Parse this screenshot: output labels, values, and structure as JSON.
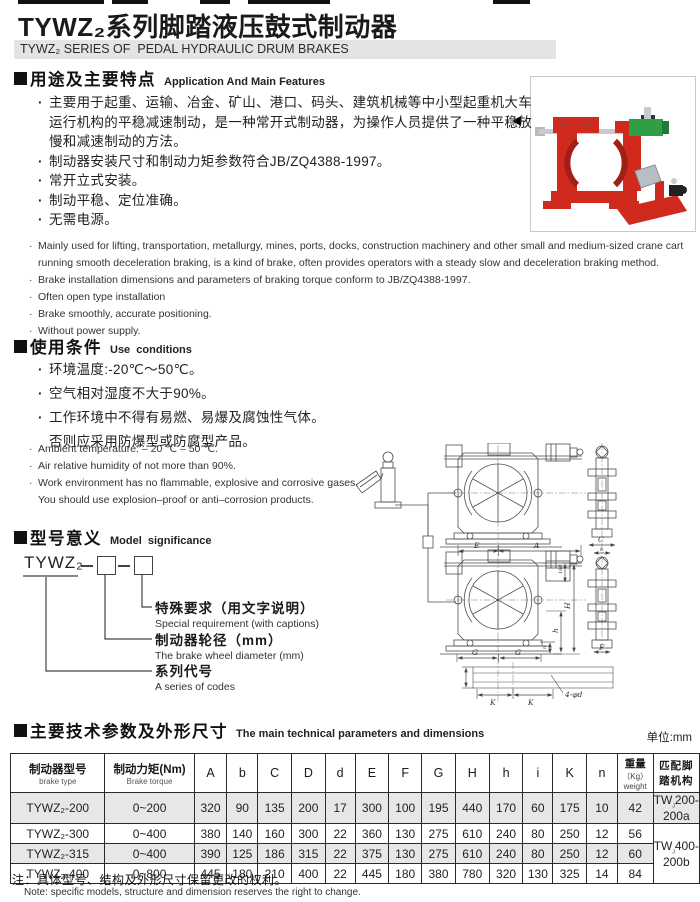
{
  "page": {
    "title": "TYWZ₂系列脚踏液压鼓式制动器",
    "subtitle": "TYWZ₂ SERIES OF  PEDAL HYDRAULIC DRUM BRAKES"
  },
  "sections": {
    "features": {
      "heading_cn": "用途及主要特点",
      "heading_en": "Application And Main Features",
      "bullets_cn": [
        "主要用于起重、运输、冶金、矿山、港口、码头、建筑机械等中小型起重机大车运行机构的平稳减速制动，是一种常开式制动器，为操作人员提供了一种平稳放慢和减速制动的方法。",
        "制动器安装尺寸和制动力矩参数符合JB/ZQ4388-1997。",
        "常开立式安装。",
        "制动平稳、定位准确。",
        "无需电源。"
      ],
      "bullets_en": [
        "Mainly used for lifting, transportation, metallurgy, mines, ports, docks, construction machinery and other small and medium-sized crane cart\nrunning smooth deceleration braking, is a kind of brake, often provides operators with a steady slow and deceleration braking method.",
        "Brake installation dimensions and parameters of braking torque conform to JB/ZQ4388-1997.",
        "Often open type installation",
        "Brake smoothly, accurate positioning.",
        "Without power supply."
      ]
    },
    "conditions": {
      "heading_cn": "使用条件",
      "heading_en": "Use  conditions",
      "bullets_cn": [
        "环境温度:-20℃～50℃。",
        "空气相对湿度不大于90%。",
        "工作环境中不得有易燃、易爆及腐蚀性气体。\n否则应采用防爆型或防腐型产品。"
      ],
      "bullets_en": [
        "Ambient temperature: – 20 ℃ – 50 ℃.",
        "Air relative humidity of not more than 90%.",
        "Work environment has no flammable, explosive and corrosive gases.\nYou should use explosion–proof or anti–corrosion products."
      ]
    },
    "model": {
      "heading_cn": "型号意义",
      "heading_en": "Model  significance",
      "code": "TYWZ₂",
      "labels": [
        {
          "cn": "特殊要求（用文字说明）",
          "en": "Special requirement (with captions)"
        },
        {
          "cn": "制动器轮径（mm）",
          "en": "The brake wheel diameter (mm)"
        },
        {
          "cn": "系列代号",
          "en": "A series of codes"
        }
      ]
    },
    "parameters": {
      "heading_cn": "主要技术参数及外形尺寸",
      "heading_en": "The main technical parameters and dimensions",
      "unit_note": "单位:mm",
      "table": {
        "col_model": {
          "cn": "制动器型号",
          "en": "brake type"
        },
        "col_torque": {
          "cn": "制动力矩(Nm)",
          "en": "Brake torque"
        },
        "dim_cols": [
          "A",
          "b",
          "C",
          "D",
          "d",
          "E",
          "F",
          "G",
          "H",
          "h",
          "i",
          "K",
          "n"
        ],
        "col_weight": {
          "lines": [
            "重量",
            "（Kg）",
            "weight"
          ]
        },
        "col_match": {
          "lines": [
            "匹配脚",
            "踏机构"
          ]
        },
        "rows": [
          {
            "model": "TYWZ₂-200",
            "torque": "0~200",
            "dims": [
              320,
              90,
              135,
              200,
              17,
              300,
              100,
              195,
              440,
              170,
              60,
              175,
              10
            ],
            "weight": 42,
            "match": {
              "pre": "TW",
              "sub": "J",
              "rest": "200-200a"
            }
          },
          {
            "model": "TYWZ₂-300",
            "torque": "0~400",
            "dims": [
              380,
              140,
              160,
              300,
              22,
              360,
              130,
              275,
              610,
              240,
              80,
              250,
              12
            ],
            "weight": 56,
            "match": {
              "pre": "TW",
              "sub": "J",
              "rest": "400-200b"
            }
          },
          {
            "model": "TYWZ₂-315",
            "torque": "0~400",
            "dims": [
              390,
              125,
              186,
              315,
              22,
              375,
              130,
              275,
              610,
              240,
              80,
              250,
              12
            ],
            "weight": 60,
            "match": null
          },
          {
            "model": "TYWZ₂-400",
            "torque": "0~800",
            "dims": [
              445,
              180,
              210,
              400,
              22,
              445,
              180,
              380,
              780,
              320,
              130,
              325,
              14
            ],
            "weight": 84,
            "match": null
          }
        ]
      },
      "note_cn": "注：具体型号、结构及外形尺寸保留更改的权利。",
      "note_en": "Note:  specific models, structure and dimension reserves the right to change."
    }
  },
  "drawing": {
    "labels": {
      "E": "E",
      "A": "A",
      "H": "H",
      "h": "h",
      "n": "n",
      "G1": "G",
      "G2": "G",
      "K1": "K",
      "K2": "K",
      "C": "C",
      "b": "b",
      "F": "F",
      "holes": "4-φd",
      "d180": "180"
    }
  }
}
